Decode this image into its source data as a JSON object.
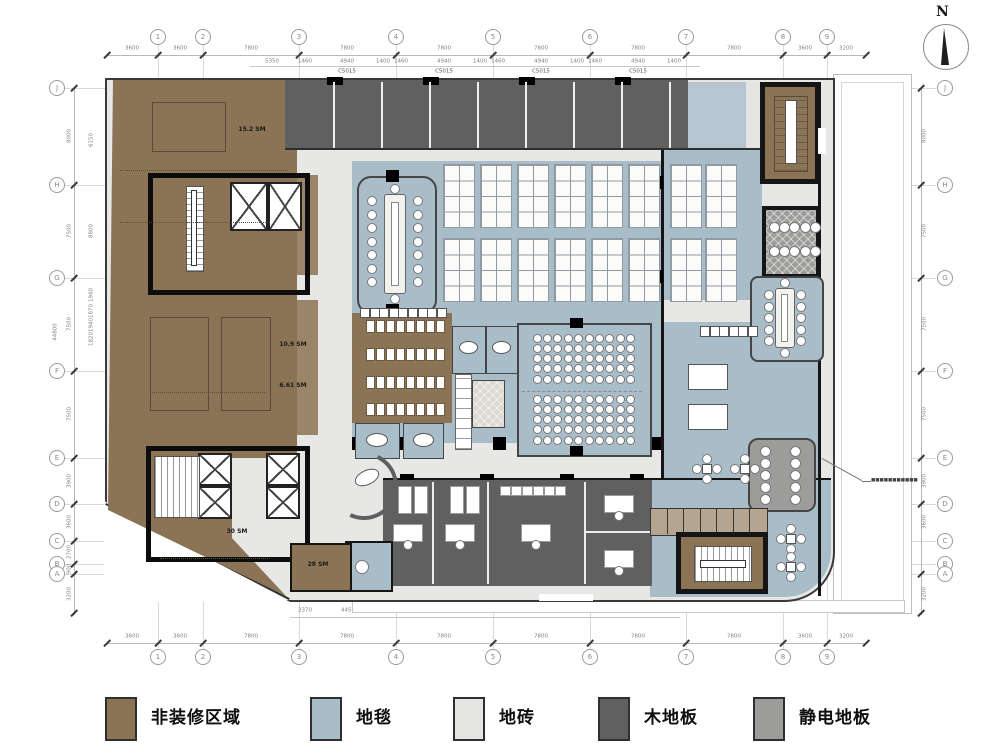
{
  "north": {
    "label": "N"
  },
  "legend": {
    "items": [
      {
        "label": "非装修区域",
        "color": "#8b7355"
      },
      {
        "label": "地毯",
        "color": "#a9bdc9"
      },
      {
        "label": "地砖",
        "color": "#e4e4e2"
      },
      {
        "label": "木地板",
        "color": "#606060"
      },
      {
        "label": "静电地板",
        "color": "#9c9c9a"
      }
    ]
  },
  "grid": {
    "top": [
      "1",
      "2",
      "3",
      "4",
      "5",
      "6",
      "7",
      "8",
      "9"
    ],
    "bottom": [
      "1",
      "2",
      "3",
      "4",
      "5",
      "6",
      "7",
      "8",
      "9"
    ],
    "left": [
      "J",
      "H",
      "G",
      "F",
      "E",
      "D",
      "C",
      "B",
      "A"
    ],
    "right": [
      "J",
      "H",
      "G",
      "F",
      "E",
      "D",
      "C",
      "B",
      "A"
    ]
  },
  "dims": {
    "top_main": [
      "3600",
      "3600",
      "7800",
      "7800",
      "7800",
      "7800",
      "7800",
      "7800",
      "3600",
      "3200"
    ],
    "top_sub": [
      "5350",
      "1460",
      "4940",
      "1400",
      "1460",
      "4940",
      "1400",
      "1460",
      "4940",
      "1400",
      "1460",
      "4940",
      "1400"
    ],
    "top_windows": [
      "C5015",
      "C5015",
      "C5015",
      "C5015"
    ],
    "bottom_main": [
      "3600",
      "3600",
      "7800",
      "7800",
      "7800",
      "7800",
      "7800",
      "7800",
      "3600",
      "3200"
    ],
    "bottom_sub": [
      "2370",
      "4450",
      "3770",
      "4450",
      "1080",
      "4450",
      "1080",
      "3885",
      "1620"
    ],
    "bottom_windows": [
      "C4515",
      "C4515",
      "C4515",
      "C4515"
    ],
    "left_main": [
      "8000",
      "7500",
      "7500",
      "7500",
      "3900",
      "3600",
      "2700",
      "900",
      "3200"
    ],
    "left_sub": [
      "6150",
      "8800",
      "1940",
      "1870",
      "1940",
      "1820"
    ],
    "left_total": "44800",
    "right_main": [
      "8000",
      "7500",
      "7500",
      "7500",
      "3900",
      "3600",
      "3200"
    ]
  },
  "room_labels": {
    "upper_lobby": "15.2 SM",
    "room_109": "10.9 SM",
    "room_661": "6.61 SM",
    "core_lobby": "30 SM",
    "room_28": "28 SM"
  },
  "annotation_right_illegible": "■■■■■■■■■■■"
}
